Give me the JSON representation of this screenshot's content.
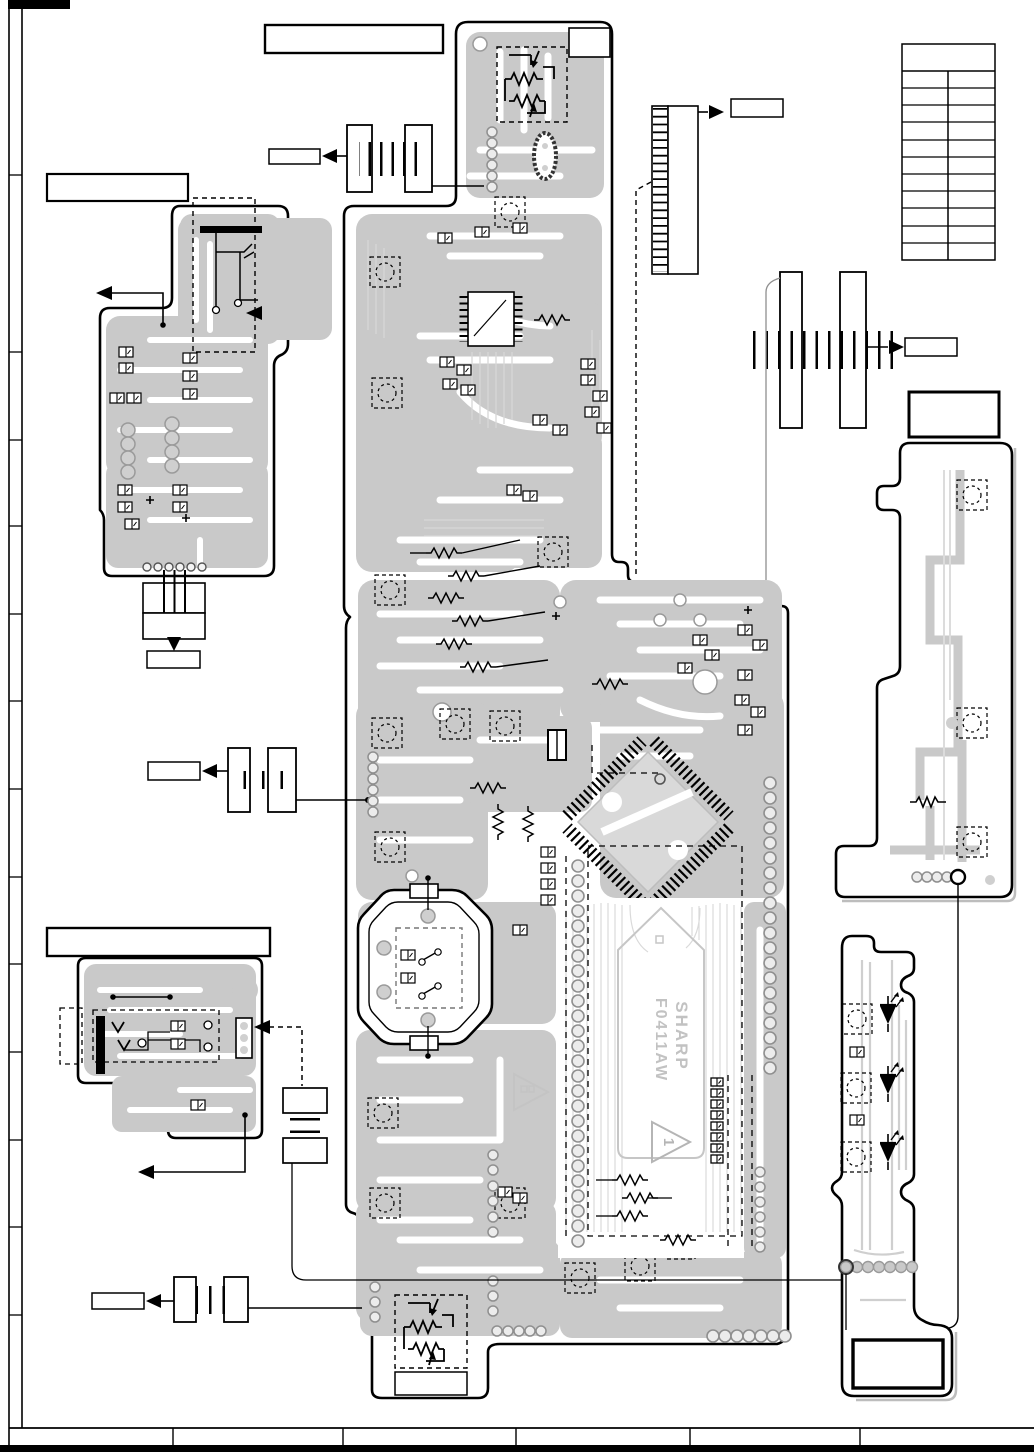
{
  "diagram": {
    "type": "pcb-pattern-diagram",
    "main_ic": {
      "brand": "SHARP",
      "part": "F0411AW"
    },
    "pin1_marker": "1",
    "colors": {
      "background": "#ffffff",
      "copper": "#c9c9c9",
      "copper_light": "#d7d7d7",
      "outline": "#000000"
    },
    "reference_table": {
      "rows": 11,
      "columns": 2,
      "header_rows": 1
    },
    "callout_boxes": "empty",
    "footer_cells": 6
  }
}
